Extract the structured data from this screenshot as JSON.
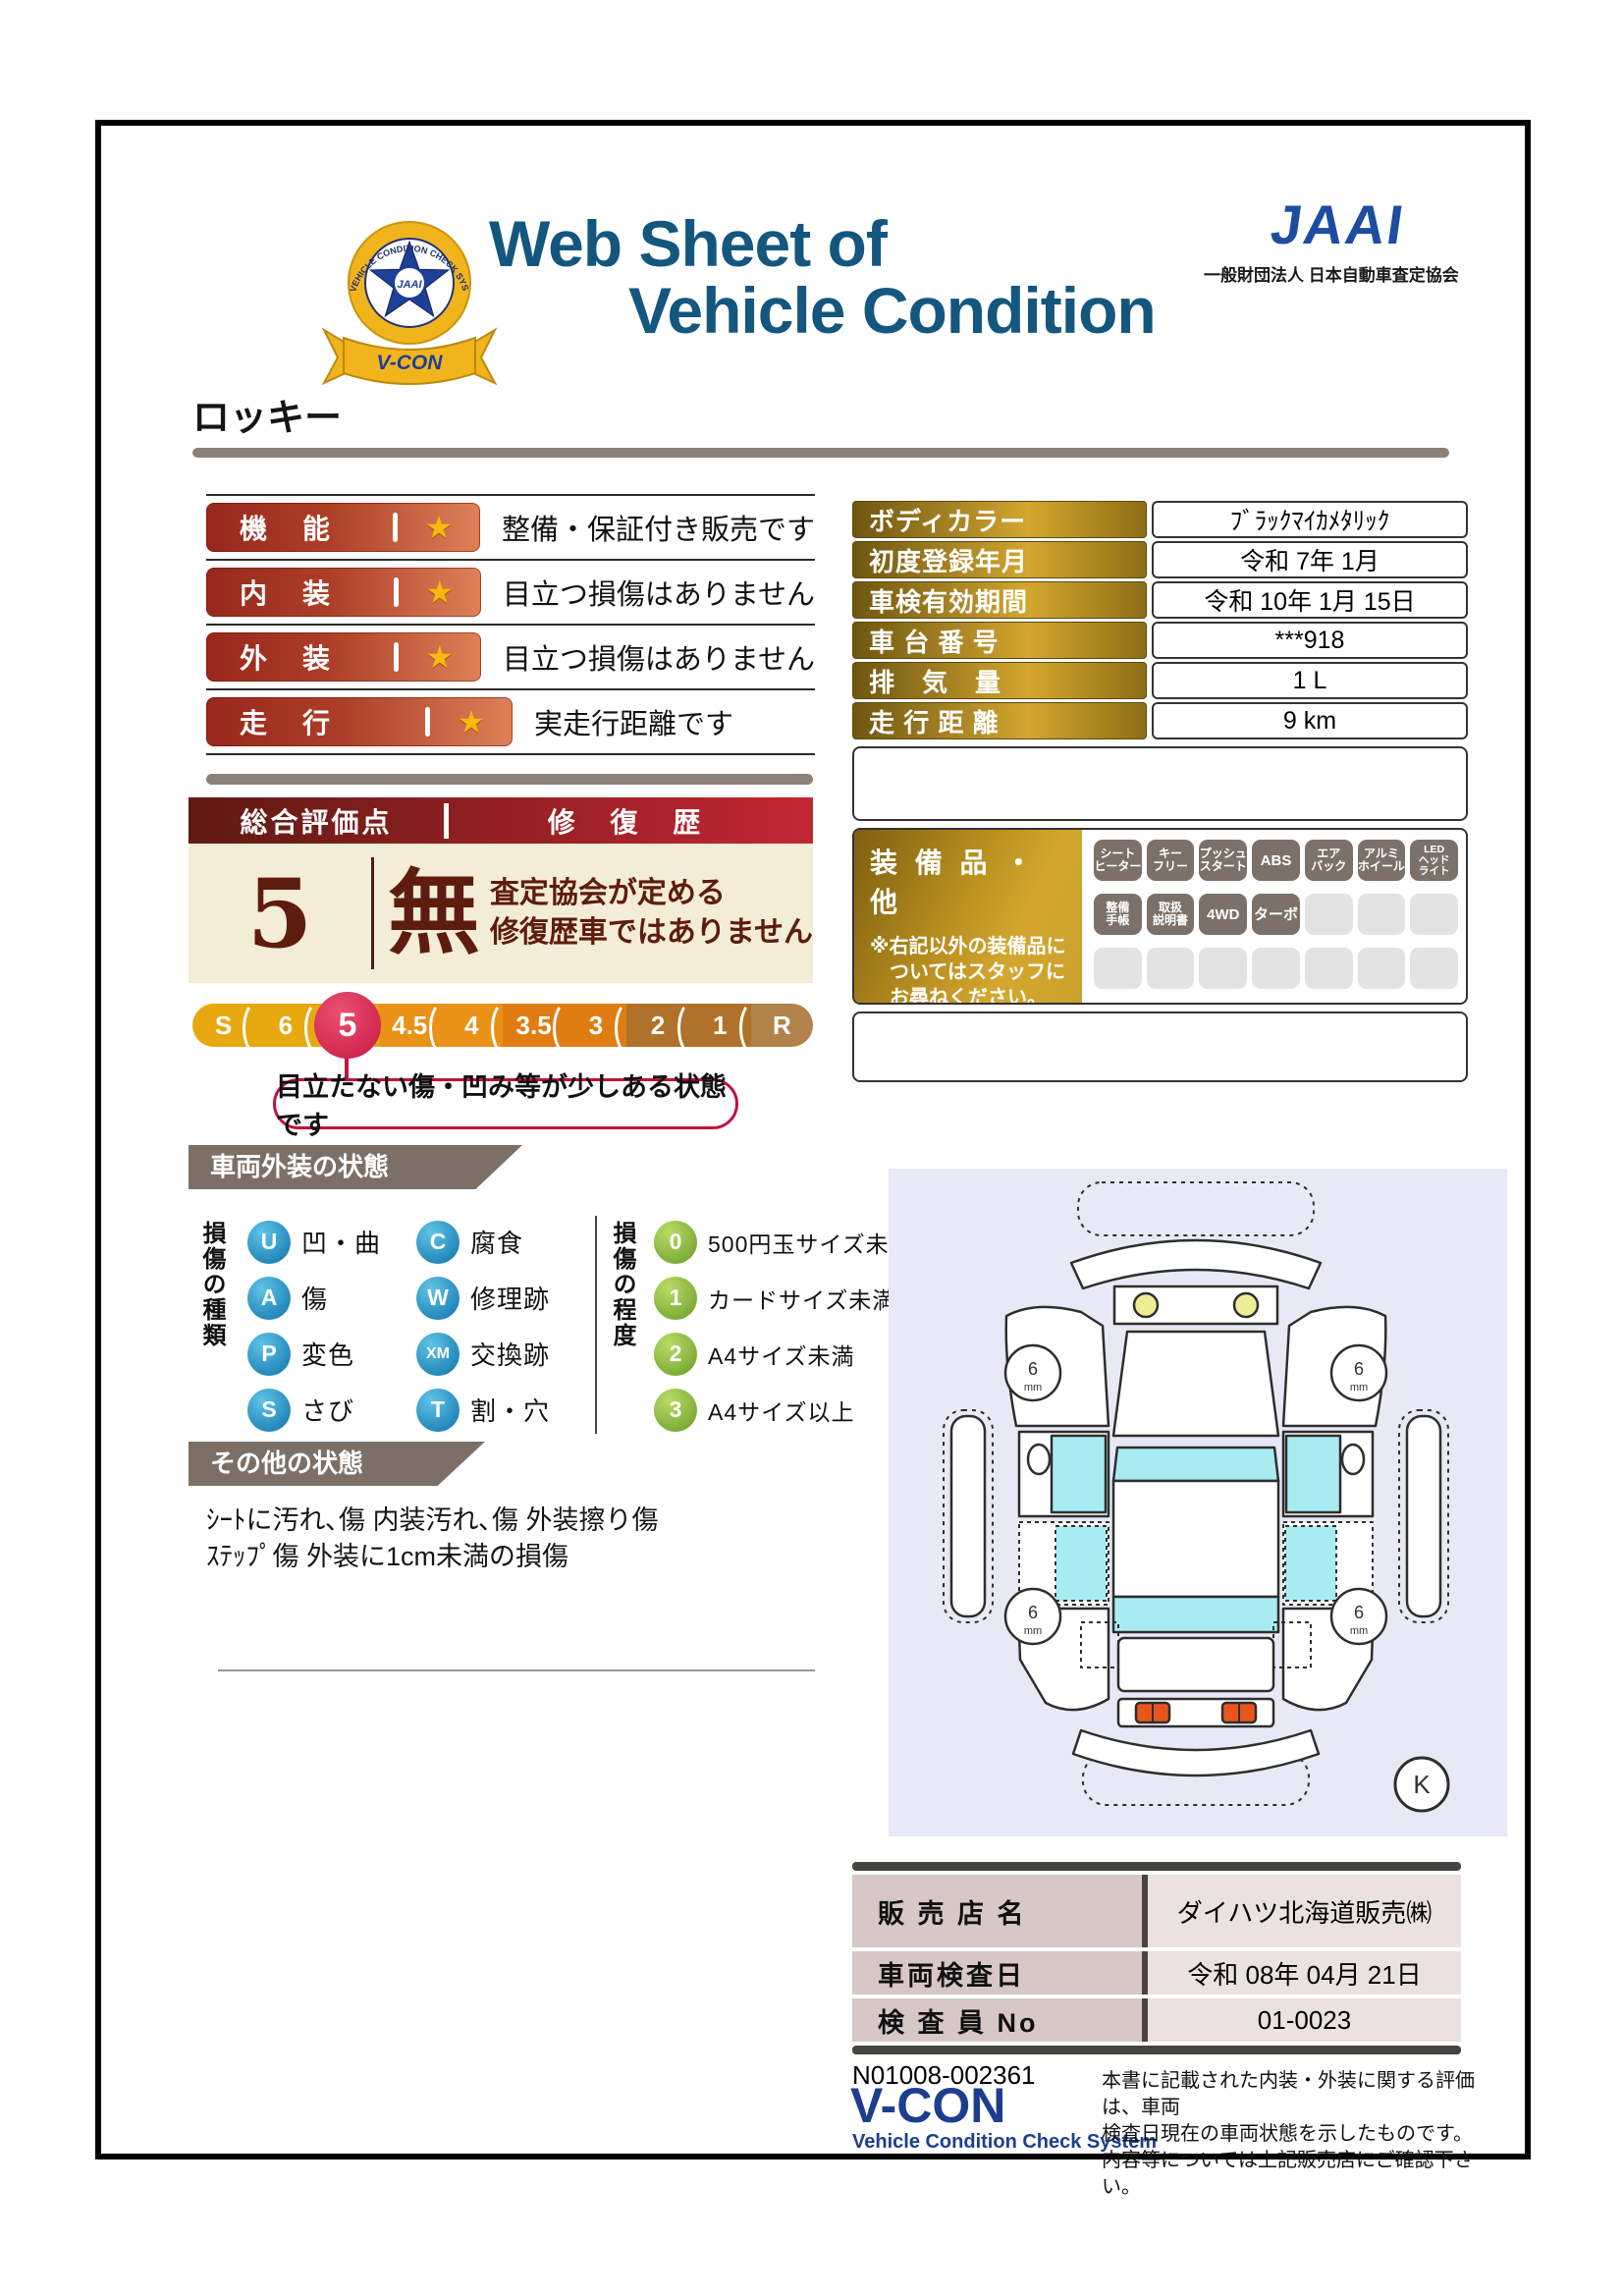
{
  "header": {
    "emblem": {
      "ring_text": "VEHICLE CONDITION CHECK SYSTEM",
      "center_text": "JAAI",
      "ribbon_text": "V-CON"
    },
    "title_line1": "Web Sheet of",
    "title_line2": "Vehicle Condition",
    "org_logo": "JAAI",
    "org_name": "一般財団法人 日本自動車査定協会"
  },
  "vehicle_name": "ロッキー",
  "ratings": [
    {
      "label": "機　能",
      "star": "★",
      "desc": "整備・保証付き販売です"
    },
    {
      "label": "内　装",
      "star": "★",
      "desc": "目立つ損傷はありません"
    },
    {
      "label": "外　装",
      "star": "★",
      "desc": "目立つ損傷はありません"
    },
    {
      "label": "走　行",
      "star": "★",
      "desc": "実走行距離です"
    }
  ],
  "overall": {
    "score_header": "総合評価点",
    "repair_header": "修 復 歴",
    "score": "5",
    "repair_value": "無",
    "repair_note_line1": "査定協会が定める",
    "repair_note_line2": "修復歴車ではありません"
  },
  "grade_scale": {
    "segments": [
      {
        "label": "S",
        "color": "#e7a90f"
      },
      {
        "label": "6",
        "color": "#e7a90f"
      },
      {
        "label": "5",
        "color": "#e7a90f",
        "selected": true
      },
      {
        "label": "4.5",
        "color": "#ea9118"
      },
      {
        "label": "4",
        "color": "#ea9118"
      },
      {
        "label": "3.5",
        "color": "#e07d12"
      },
      {
        "label": "3",
        "color": "#e07d12"
      },
      {
        "label": "2",
        "color": "#b0722a"
      },
      {
        "label": "1",
        "color": "#b0722a"
      },
      {
        "label": "R",
        "color": "#b1824b"
      }
    ],
    "selected_color": "#c81843",
    "callout": "目立たない傷・凹み等が少しある状態です"
  },
  "info_table": {
    "rows": [
      {
        "label": "ボディカラー",
        "value": "ﾌﾞﾗｯｸﾏｲｶﾒﾀﾘｯｸ"
      },
      {
        "label": "初度登録年月",
        "value": "令和 7年 1月"
      },
      {
        "label": "車検有効期間",
        "value": "令和 10年 1月 15日"
      },
      {
        "label": "車 台 番 号",
        "value": "***918"
      },
      {
        "label": "排　気　量",
        "value": "1 L"
      },
      {
        "label": "走 行 距 離",
        "value": "9 km"
      }
    ]
  },
  "equipment": {
    "title": "装 備 品 ・ 他",
    "note_line1": "※右記以外の装備品に",
    "note_line2": "ついてはスタッフに",
    "note_line3": "お尋ねください。",
    "badges": [
      "シート\nヒーター",
      "キー\nフリー",
      "プッシュ\nスタート",
      "ABS",
      "エア\nバック",
      "アルミ\nホイール",
      "LED\nヘッド\nライト",
      "整備\n手帳",
      "取扱\n説明書",
      "4WD",
      "ターボ"
    ],
    "total_slots": 21
  },
  "exterior": {
    "banner": "車両外装の状態",
    "kind_title": "損傷の種類",
    "kinds": [
      {
        "code": "U",
        "label": "凹・曲"
      },
      {
        "code": "A",
        "label": "傷"
      },
      {
        "code": "P",
        "label": "変色"
      },
      {
        "code": "S",
        "label": "さび"
      },
      {
        "code": "C",
        "label": "腐食"
      },
      {
        "code": "W",
        "label": "修理跡"
      },
      {
        "code": "XM",
        "label": "交換跡"
      },
      {
        "code": "T",
        "label": "割・穴"
      }
    ],
    "degree_title": "損傷の程度",
    "degrees": [
      {
        "code": "0",
        "label": "500円玉サイズ未満"
      },
      {
        "code": "1",
        "label": "カードサイズ未満"
      },
      {
        "code": "2",
        "label": "A4サイズ未満"
      },
      {
        "code": "3",
        "label": "A4サイズ以上"
      }
    ]
  },
  "other_state": {
    "banner": "その他の状態",
    "line1": "ｼｰﾄに汚れ､傷 内装汚れ､傷 外装擦り傷",
    "line2": "ｽﾃｯﾌﾟ傷 外装に1cm未満の損傷"
  },
  "diagram": {
    "tires": [
      "6",
      "6",
      "6",
      "6"
    ],
    "tire_unit": "mm",
    "corner_mark": "K"
  },
  "dealer_table": {
    "rows": [
      {
        "label": "販 売 店 名",
        "value": "ダイハツ北海道販売㈱"
      },
      {
        "label": "車両検査日",
        "value": "令和 08年 04月 21日"
      },
      {
        "label": "検 査 員 No",
        "value": "01-0023"
      }
    ]
  },
  "footer": {
    "serial": "N01008-002361",
    "brand": "V-CON",
    "brand_sub": "Vehicle Condition Check System",
    "disclaimer_line1": "本書に記載された内装・外装に関する評価は、車両",
    "disclaimer_line2": "検査日現在の車両状態を示したものです。",
    "disclaimer_line3": "内容等については上記販売店にご確認下さい。"
  },
  "colors": {
    "title_blue": "#14577e",
    "org_blue": "#1e4da0",
    "rating_red_dark": "#97271c",
    "rating_red_light": "#dd8159",
    "gold_dark": "#6e5711",
    "gold_light": "#d3a72f",
    "maroon": "#5e1c0e",
    "cream": "#f3ecd7",
    "banner_taupe": "#7c7066",
    "badge_gray": "#7b7168",
    "diagram_bg": "#e8e9f5",
    "glass_cyan": "#a8ecf2",
    "selected_grade": "#c2123e"
  }
}
